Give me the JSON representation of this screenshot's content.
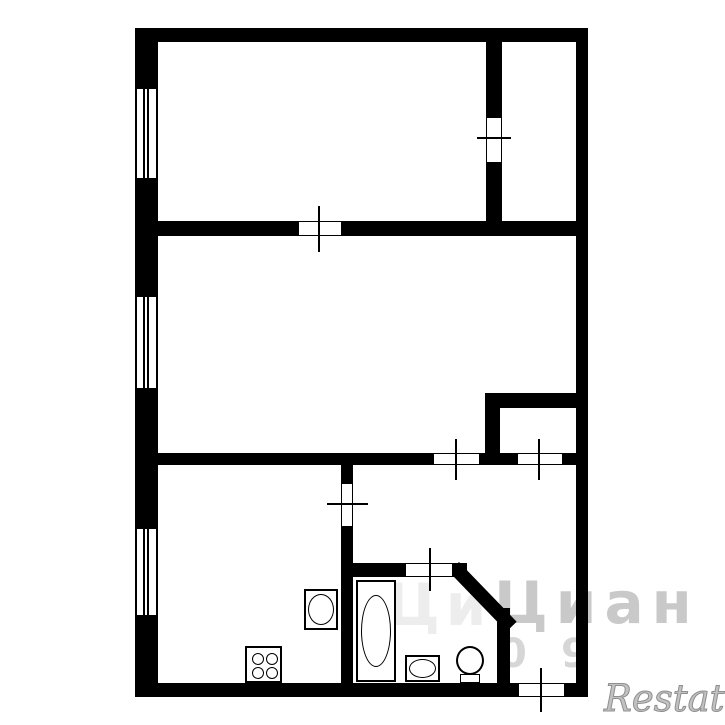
{
  "document": {
    "type": "apartment-floor-plan",
    "canvas": {
      "width": 725,
      "height": 725,
      "background": "#ffffff",
      "wall_color": "#000000"
    }
  },
  "plan": {
    "walls": [
      {
        "name": "outer-wall-top",
        "x": 135,
        "y": 28,
        "w": 453,
        "h": 14
      },
      {
        "name": "outer-wall-left-a",
        "x": 135,
        "y": 28,
        "w": 23,
        "h": 59
      },
      {
        "name": "outer-wall-left-b",
        "x": 135,
        "y": 180,
        "w": 23,
        "h": 115
      },
      {
        "name": "outer-wall-left-c",
        "x": 135,
        "y": 390,
        "w": 23,
        "h": 137
      },
      {
        "name": "outer-wall-left-d",
        "x": 135,
        "y": 617,
        "w": 23,
        "h": 80
      },
      {
        "name": "outer-wall-right",
        "x": 576,
        "y": 28,
        "w": 12,
        "h": 669
      },
      {
        "name": "outer-wall-bottom-a",
        "x": 135,
        "y": 683,
        "w": 383,
        "h": 14
      },
      {
        "name": "outer-wall-bottom-b",
        "x": 565,
        "y": 683,
        "w": 23,
        "h": 14
      },
      {
        "name": "divider-topright-upper",
        "x": 486,
        "y": 42,
        "w": 16,
        "h": 75
      },
      {
        "name": "divider-topright-lower",
        "x": 486,
        "y": 163,
        "w": 16,
        "h": 58
      },
      {
        "name": "wall-h1-left",
        "x": 158,
        "y": 221,
        "w": 140,
        "h": 15
      },
      {
        "name": "wall-h1-right",
        "x": 342,
        "y": 221,
        "w": 234,
        "h": 15
      },
      {
        "name": "wall-h2-a",
        "x": 158,
        "y": 453,
        "w": 275,
        "h": 12
      },
      {
        "name": "wall-h2-b",
        "x": 480,
        "y": 453,
        "w": 37,
        "h": 12
      },
      {
        "name": "wall-h2-c",
        "x": 563,
        "y": 453,
        "w": 13,
        "h": 12
      },
      {
        "name": "closet-wall-top",
        "x": 485,
        "y": 393,
        "w": 103,
        "h": 15
      },
      {
        "name": "closet-wall-left",
        "x": 485,
        "y": 405,
        "w": 15,
        "h": 60
      },
      {
        "name": "kitchen-wall-upper",
        "x": 341,
        "y": 465,
        "w": 12,
        "h": 18
      },
      {
        "name": "kitchen-wall-lower",
        "x": 341,
        "y": 527,
        "w": 12,
        "h": 156
      },
      {
        "name": "bath-wall-top-left",
        "x": 341,
        "y": 563,
        "w": 64,
        "h": 14
      },
      {
        "name": "bath-wall-top-right",
        "x": 453,
        "y": 563,
        "w": 14,
        "h": 14
      },
      {
        "name": "bath-wall-right",
        "x": 497,
        "y": 608,
        "w": 13,
        "h": 75
      }
    ],
    "diagonal_wall": {
      "name": "bath-diagonal-wall",
      "x": 459,
      "y": 562,
      "len": 83,
      "th": 14,
      "angle": 46
    },
    "windows": [
      {
        "name": "window-room1",
        "x": 135,
        "y": 87,
        "w": 23,
        "h": 93
      },
      {
        "name": "window-room2",
        "x": 135,
        "y": 295,
        "w": 23,
        "h": 95
      },
      {
        "name": "window-kitchen",
        "x": 135,
        "y": 527,
        "w": 23,
        "h": 90
      }
    ],
    "doors": [
      {
        "name": "door-topright-room",
        "x": 486,
        "y": 117,
        "w": 16,
        "h": 46,
        "tick": {
          "x": 477,
          "y": 137,
          "w": 34,
          "h": 2
        }
      },
      {
        "name": "door-room1",
        "x": 298,
        "y": 221,
        "w": 44,
        "h": 15,
        "tick": {
          "x": 318,
          "y": 206,
          "w": 2,
          "h": 46
        }
      },
      {
        "name": "door-room2-hall",
        "x": 433,
        "y": 453,
        "w": 47,
        "h": 12,
        "tick": {
          "x": 455,
          "y": 439,
          "w": 2,
          "h": 41
        }
      },
      {
        "name": "door-closet",
        "x": 517,
        "y": 453,
        "w": 46,
        "h": 12,
        "tick": {
          "x": 538,
          "y": 439,
          "w": 2,
          "h": 41
        }
      },
      {
        "name": "door-kitchen",
        "x": 341,
        "y": 483,
        "w": 12,
        "h": 44,
        "tick": {
          "x": 327,
          "y": 503,
          "w": 41,
          "h": 2
        }
      },
      {
        "name": "door-bathroom",
        "x": 405,
        "y": 563,
        "w": 48,
        "h": 14,
        "tick": {
          "x": 429,
          "y": 548,
          "w": 2,
          "h": 43
        }
      },
      {
        "name": "door-balcony",
        "x": 518,
        "y": 683,
        "w": 47,
        "h": 14,
        "tick": {
          "x": 540,
          "y": 668,
          "w": 2,
          "h": 44
        }
      }
    ],
    "fixtures": {
      "stove": {
        "x": 245,
        "y": 646,
        "w": 37,
        "h": 37,
        "burner_d": 12
      },
      "kitchen_sink": {
        "x": 304,
        "y": 589,
        "w": 34,
        "h": 41
      },
      "bathtub": {
        "x": 356,
        "y": 580,
        "w": 40,
        "h": 102
      },
      "wash_basin": {
        "x": 405,
        "y": 655,
        "w": 35,
        "h": 27
      },
      "toilet": {
        "bowl": {
          "x": 456,
          "y": 646,
          "w": 28,
          "h": 29
        },
        "tank": {
          "x": 460,
          "y": 674,
          "w": 20,
          "h": 9
        }
      }
    },
    "watermarks": [
      {
        "name": "watermark-cian-faint",
        "text": "Ци",
        "x": 386,
        "y": 576,
        "size": 58,
        "color": "#ededed",
        "spacing": 6
      },
      {
        "name": "watermark-cian",
        "text": "Циан",
        "x": 494,
        "y": 574,
        "size": 58,
        "color": "#c9c9c9",
        "spacing": 8
      },
      {
        "name": "watermark-digit-0",
        "text": "0",
        "x": 499,
        "y": 634,
        "size": 40,
        "color": "#d6d6d6",
        "spacing": 0
      },
      {
        "name": "watermark-digit-9",
        "text": "9",
        "x": 561,
        "y": 634,
        "size": 40,
        "color": "#d6d6d6",
        "spacing": 0
      }
    ],
    "brand_watermark": {
      "name": "watermark-restate",
      "text": "Restate",
      "x": 604,
      "y": 680,
      "size": 37,
      "color": "#c2c2c2"
    }
  }
}
